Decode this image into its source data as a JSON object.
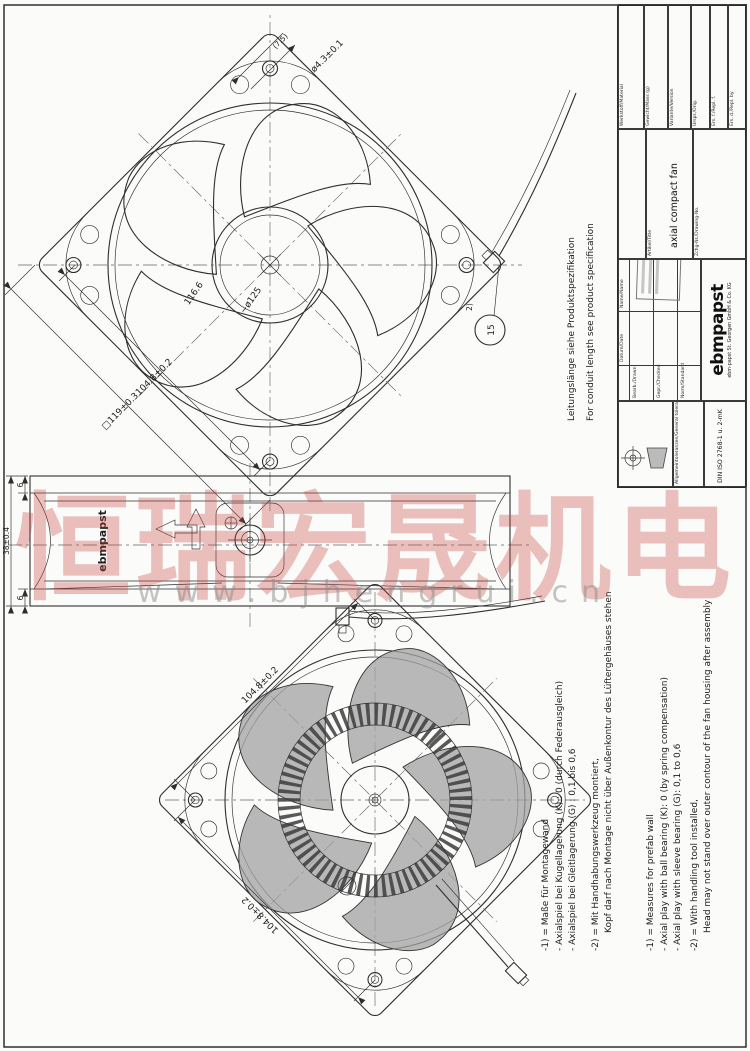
{
  "watermark": {
    "text": "恒瑞宏晟机电",
    "url": "www.bjhengrui.cn"
  },
  "conduit_note": {
    "de": "Leitungslänge siehe Produktspezifikation",
    "en": "For conduit length see product specification"
  },
  "notes": {
    "de": [
      "-1) = Maße für Montagewand",
      "- Axialspiel bei Kugellagerung (K) : 0 (durch Federausgleich)",
      "- Axialspiel bei Gleitlagerung (G) : 0,1 bis 0,6",
      "-2) = Mit Handhabungswerkzeug montiert,",
      "Kopf darf nach Montage nicht über Außenkontur des Lüftergehäuses stehen"
    ],
    "en": [
      "-1) = Measures for prefab wall",
      "- Axial play with ball bearing (K): 0 (by spring compensation)",
      "- Axial play with sleeve bearing (G): 0,1 to 0,6",
      "-2) = With handling tool installed,",
      "Head may not stand over outer contour of the fan housing after assembly"
    ]
  },
  "dims": {
    "outer": "□119±0.3",
    "pitch": "104.8±0.2",
    "hole": "ø4.3±0.1",
    "hole_ref": "(7.5)",
    "ring": "116.6",
    "venturi": "~ø125",
    "depth": "38±0.4",
    "flange": "6",
    "balloon": "15",
    "balloon_ref": "2)"
  },
  "side": {
    "brand": "ebmpapst"
  },
  "titleblock": {
    "tol_label": "Allgemeintoleranzen/General tolerances",
    "tol_value": "DIN ISO 2768-1 u. 2-mK",
    "date": "Datum/Date",
    "name": "Name/Name",
    "drawn": "Bearb./Drawn",
    "checked": "Gepr./Checked",
    "standard": "Norm/Standard",
    "logo": "ebmpapst",
    "company": "ebm-papst St. Georgen GmbH & Co. KG",
    "article_label": "Artikel/Title",
    "article": "axial compact fan",
    "drawing_no_label": "Zchg-Nr./Drawing-No.",
    "material": "Werkstoff/Material",
    "mass": "Gewicht/Mass (g)",
    "variant": "Variante/Version",
    "orig": "Urspr./Orig.",
    "repl_f": "Ers. f./Repl. f.",
    "repl_b": "Ers. d./Repl. by"
  }
}
